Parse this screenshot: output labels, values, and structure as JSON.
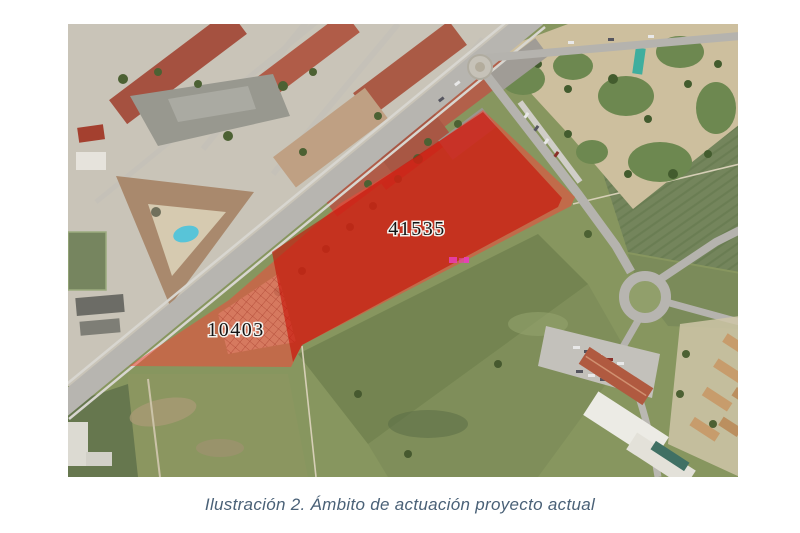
{
  "figure": {
    "caption": "Ilustración 2. Ámbito de actuación proyecto actual"
  },
  "map": {
    "kind": "aerial-orthophoto",
    "labels": {
      "parcel_main": "41535",
      "parcel_secondary": "10403"
    },
    "colors": {
      "overlay_light": "#f04838",
      "overlay_strong": "#c81005",
      "parcel_label_text": "#141414",
      "caption_text": "#4a6177",
      "pool": "#58c4d8",
      "magenta_mark": "#e83fb8"
    }
  }
}
